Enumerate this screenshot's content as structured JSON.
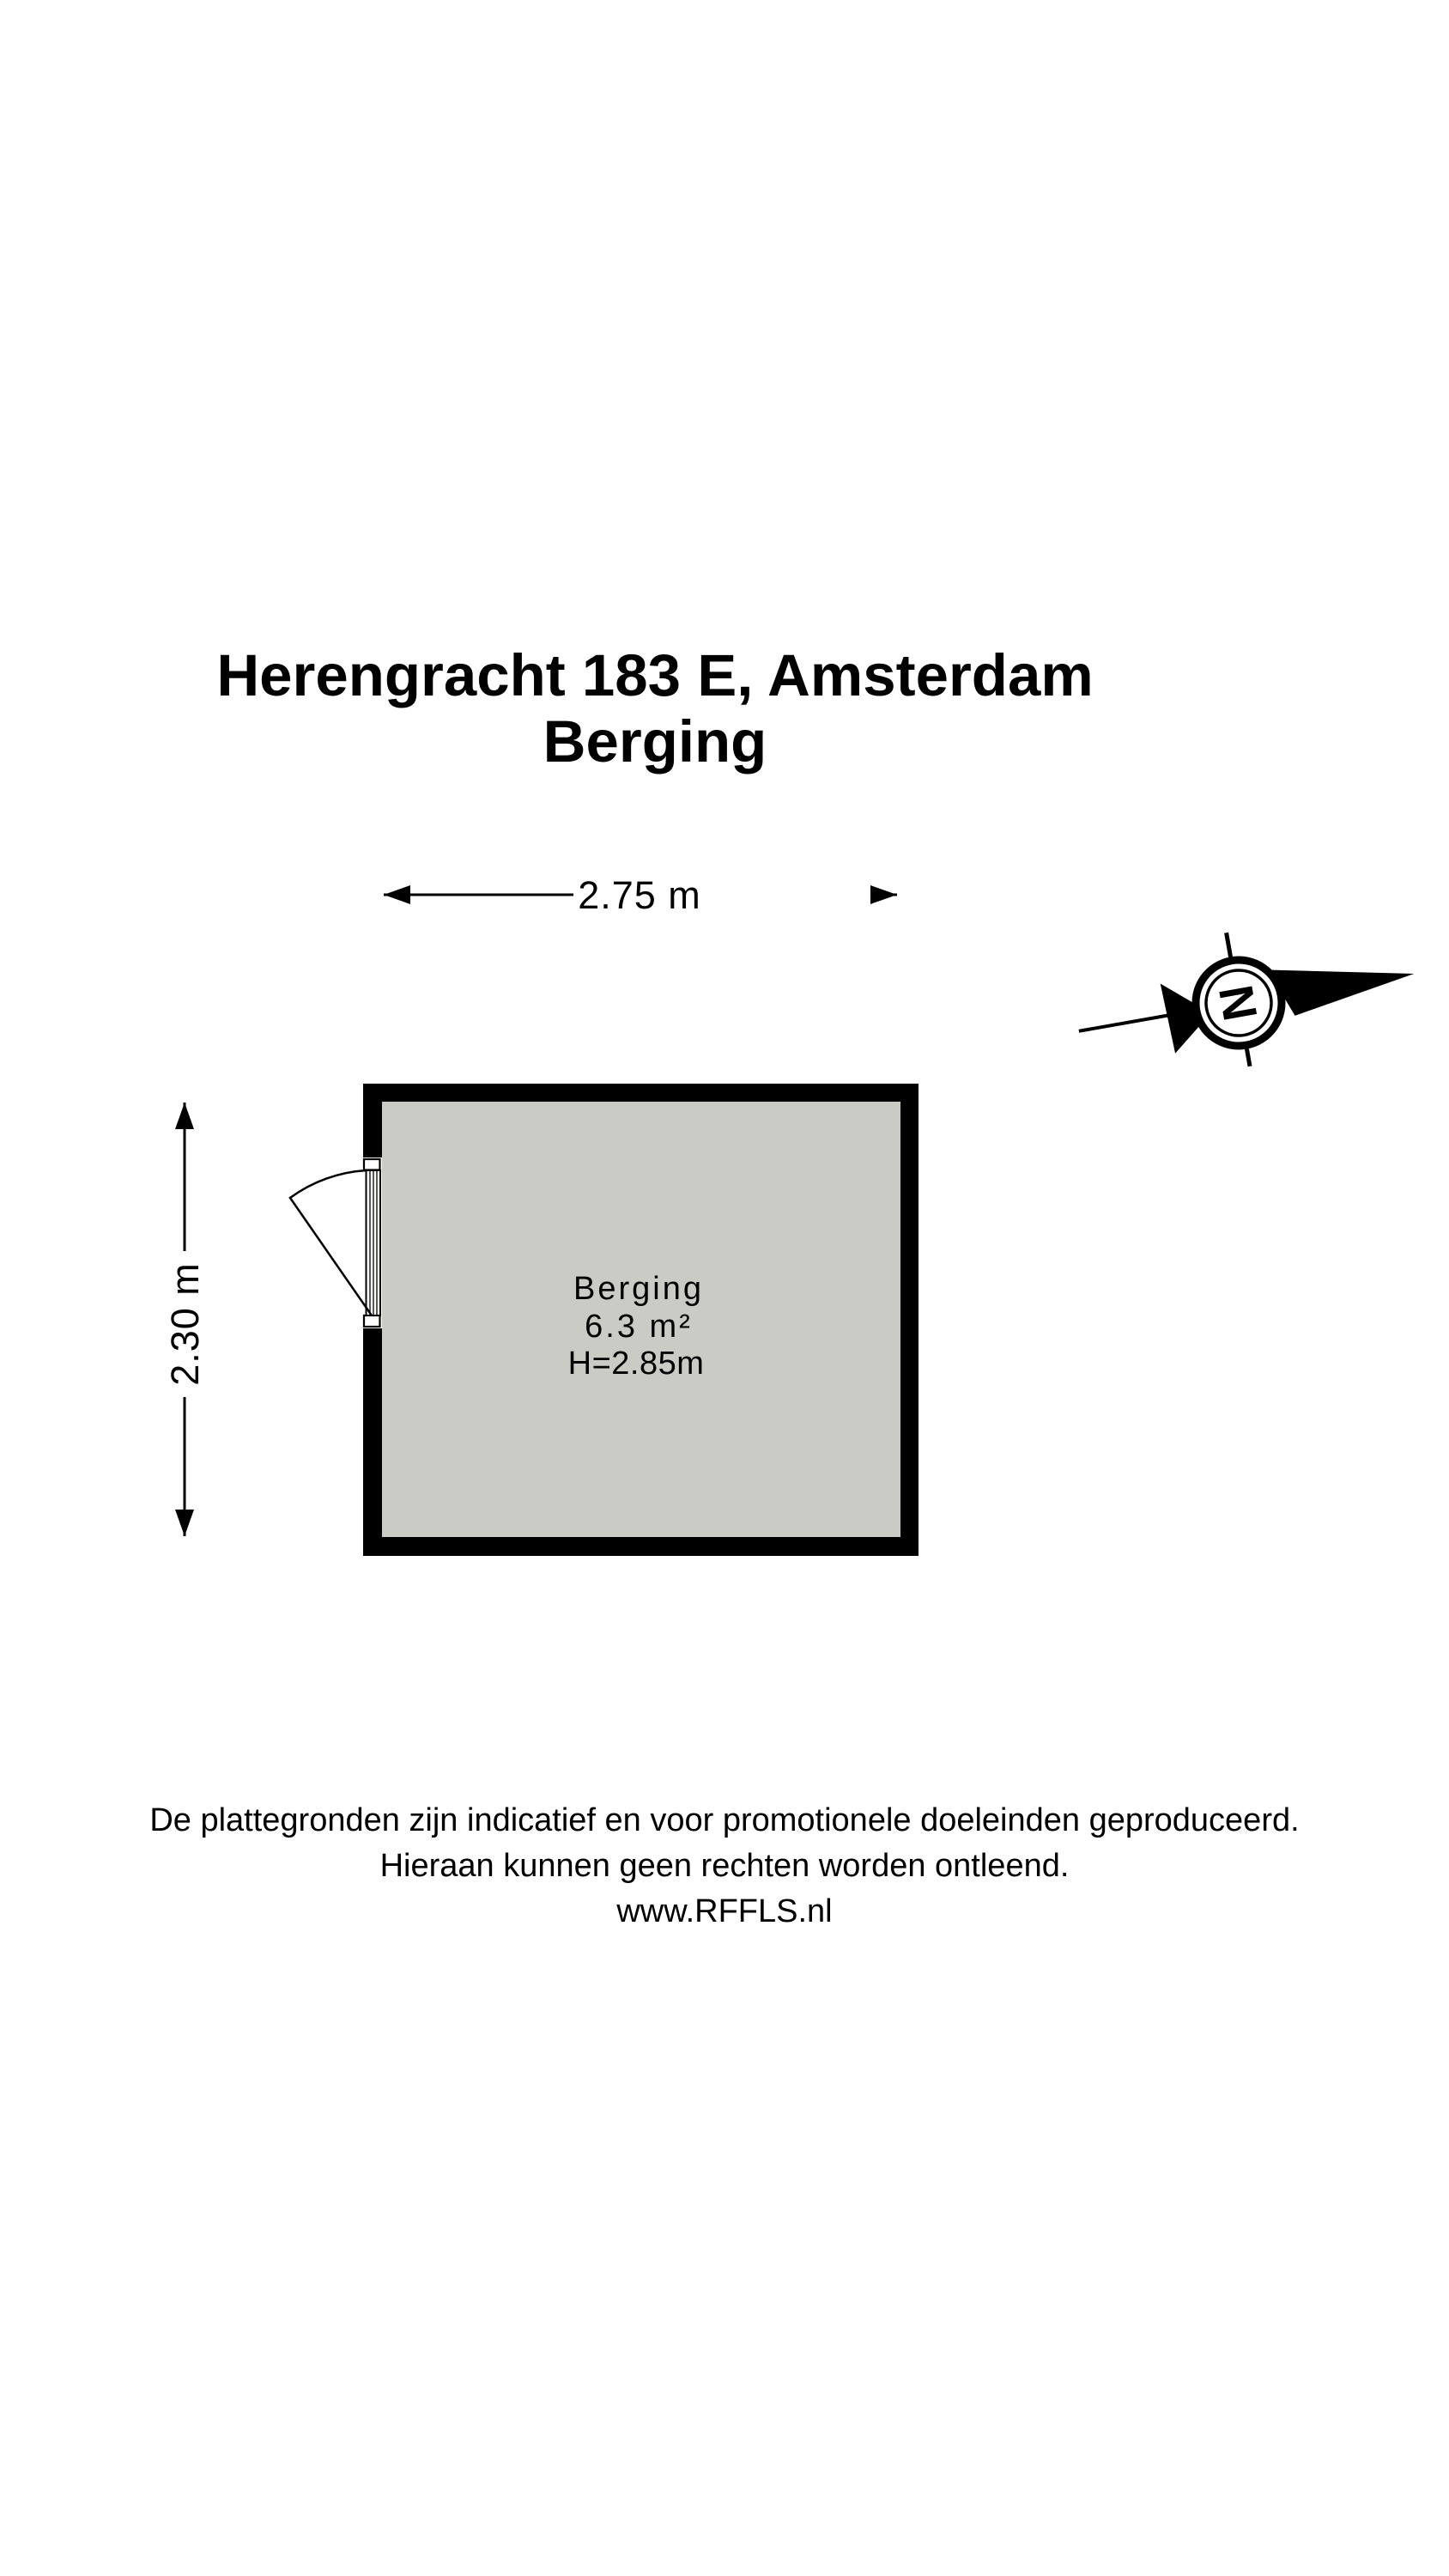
{
  "title": {
    "line1": "Herengracht 183 E, Amsterdam",
    "line2": "Berging"
  },
  "dimensions": {
    "width_label": "2.75 m",
    "height_label": "2.30 m"
  },
  "room": {
    "name": "Berging",
    "area": "6.3 m²",
    "ceiling_height": "H=2.85m"
  },
  "compass": {
    "letter": "N"
  },
  "footer": {
    "line1": "De plattegronden zijn indicatief en voor promotionele doeleinden geproduceerd.",
    "line2": "Hieraan kunnen geen rechten worden ontleend.",
    "line3": "www.RFFLS.nl"
  },
  "colors": {
    "wall": "#000000",
    "floor": "#c9cbc4",
    "background": "#ffffff",
    "text": "#000000"
  }
}
